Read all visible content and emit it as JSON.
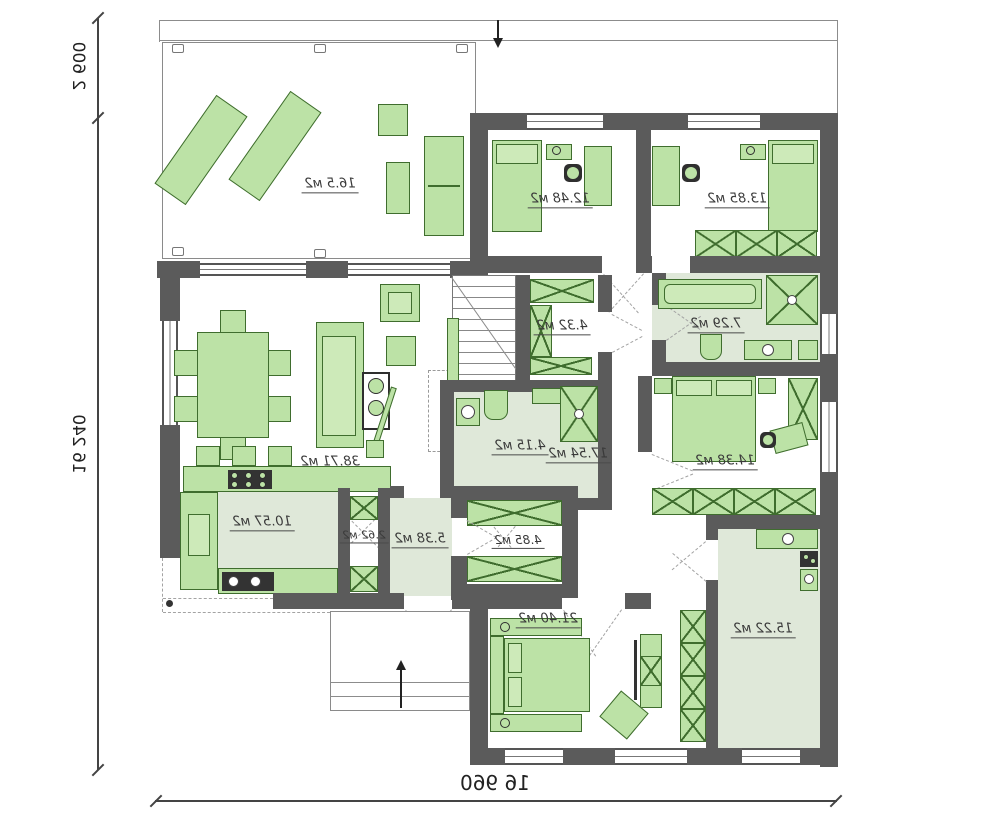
{
  "plan": {
    "type": "floor-plan",
    "rooms": {
      "terrace": {
        "area": "16.5 м2"
      },
      "child_bedroom_1": {
        "area": "12.48 м2"
      },
      "child_bedroom_2": {
        "area": "13.85 м2"
      },
      "wardrobe": {
        "area": "4.32 м2"
      },
      "bathroom_1": {
        "area": "7.29 м2"
      },
      "bathroom_2": {
        "area": "4.15 м2"
      },
      "hallway": {
        "area": "17.54 м2"
      },
      "bedroom": {
        "area": "14.38 м2"
      },
      "living_room": {
        "area": "38.71 м2"
      },
      "kitchen": {
        "area": "10.57 м2"
      },
      "pantry": {
        "area": "2.62 м2"
      },
      "hall": {
        "area": "5.38 м2"
      },
      "closet": {
        "area": "4.85 м2"
      },
      "master_bedroom": {
        "area": "21.40 м2"
      },
      "utility": {
        "area": "15.22 м2"
      }
    },
    "dimensions": {
      "total_width": "16 960",
      "total_height": "16 240",
      "terrace_depth": "2 600"
    },
    "colors": {
      "wall": "#5b5b5b",
      "furniture": "#bce2a6",
      "furniture_border": "#3f6d2e",
      "tinted_floor": "#dfe8d9"
    }
  }
}
